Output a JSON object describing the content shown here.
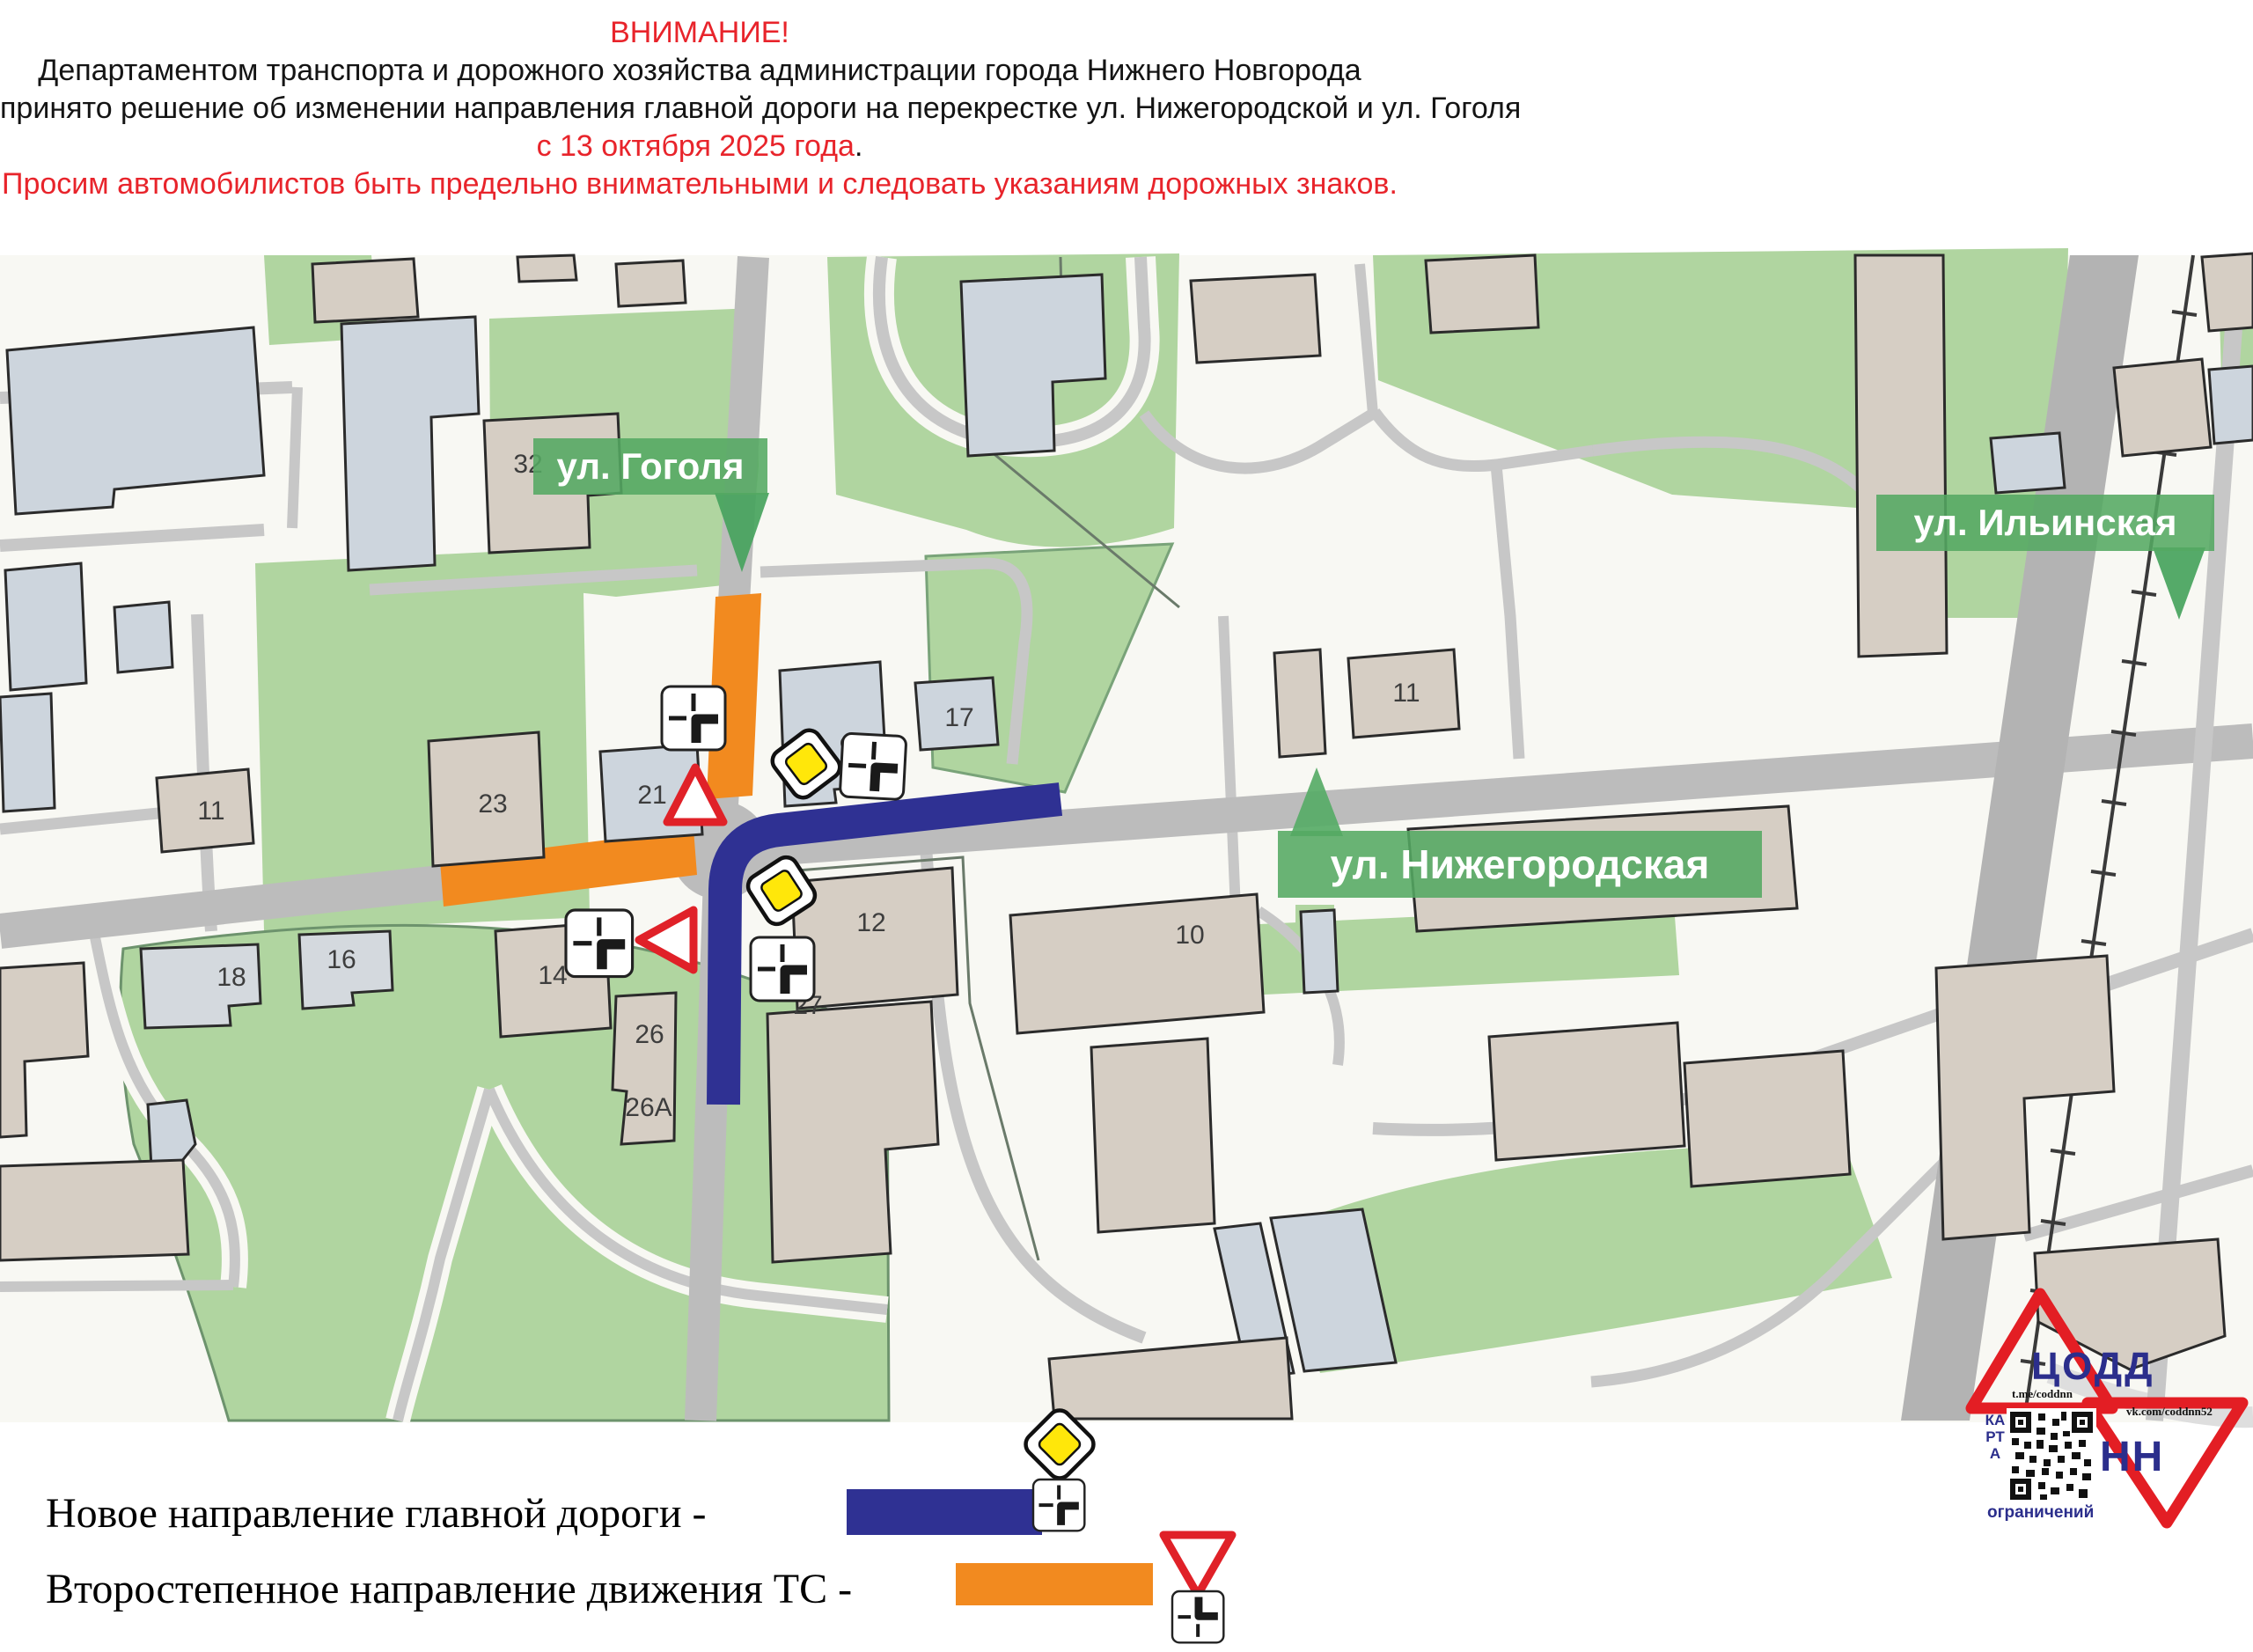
{
  "header": {
    "line1": "ВНИМАНИЕ!",
    "line2": "Департаментом транспорта и дорожного хозяйства администрации города Нижнего Новгорода",
    "line3": "принято решение об изменении направления главной дороги на перекрестке ул. Нижегородской и ул. Гоголя",
    "line4_red": "с 13 октября 2025 года",
    "line4_black": ".",
    "line5": "Просим автомобилистов быть предельно внимательными и следовать указаниям дорожных знаков."
  },
  "map": {
    "street_labels": {
      "gogolya": "ул. Гоголя",
      "ilinskaya": "ул. Ильинская",
      "nizhegorodskaya": "ул. Нижегородская"
    },
    "building_numbers": {
      "n32": "32",
      "n23": "23",
      "n21": "21",
      "n11_left": "11",
      "n9": "9",
      "n17": "17",
      "n11_right": "11",
      "n12": "12",
      "n10": "10",
      "n14": "14",
      "n16": "16",
      "n18": "18",
      "n26": "26",
      "n26a": "26А",
      "n27": "27"
    }
  },
  "legend": {
    "main_label": "Новое направление главной дороги -",
    "secondary_label": "Второстепенное направление движения ТС -",
    "main_color": "#2f3193",
    "secondary_color": "#f28a1f"
  },
  "logo": {
    "org": "ЦОДД",
    "city": "НН",
    "telegram": "t.me/coddnn",
    "vk": "vk.com/coddnn52",
    "qr_caption_vertical": "КАРТА",
    "qr_caption_bottom": "ограничений"
  }
}
